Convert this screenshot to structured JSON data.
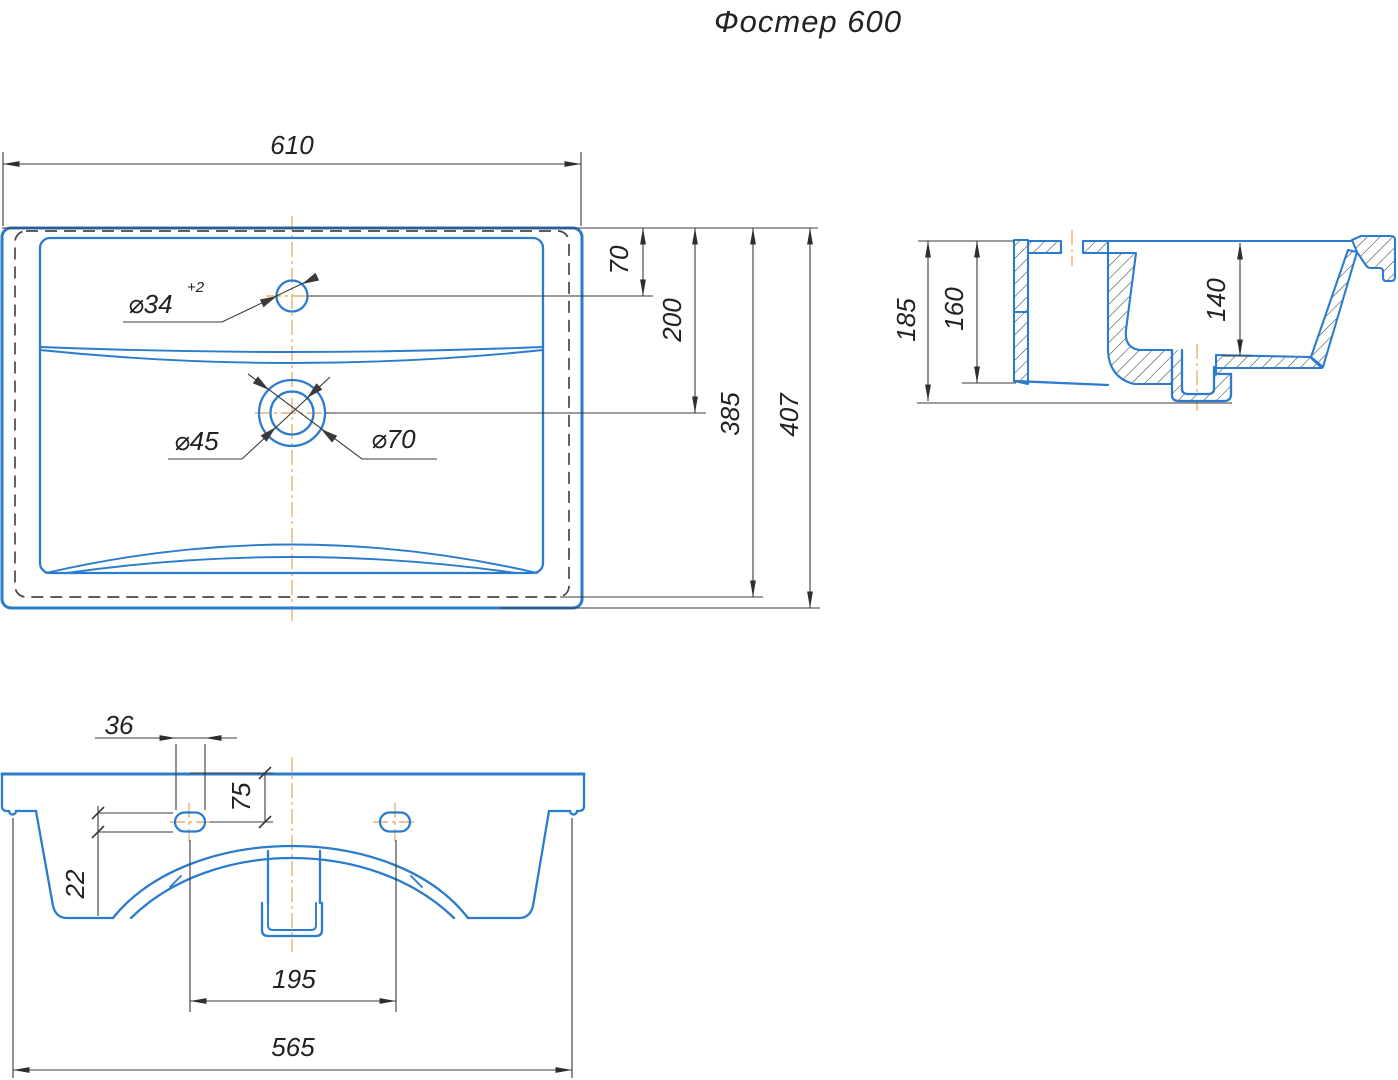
{
  "title": "Фостер 600",
  "colors": {
    "blue": "#2b7ccc",
    "dim": "#3a3a3a",
    "hidden": "#44484e",
    "center": "#ecaf72",
    "text": "#222222"
  },
  "plan_view": {
    "overall_width": "610",
    "faucet_offset": "70",
    "drain_offset": "200",
    "hidden_depth": "385",
    "overall_depth": "407",
    "faucet_hole": "⌀34",
    "faucet_hole_tolerance": "+2",
    "drain_inner": "⌀45",
    "drain_outer": "⌀70"
  },
  "section_view": {
    "overall_height": "185",
    "back_height": "160",
    "bowl_depth": "140"
  },
  "front_view": {
    "slot_length": "36",
    "slot_offset": "75",
    "slot_height": "22",
    "slot_spacing": "195",
    "base_width": "565"
  }
}
